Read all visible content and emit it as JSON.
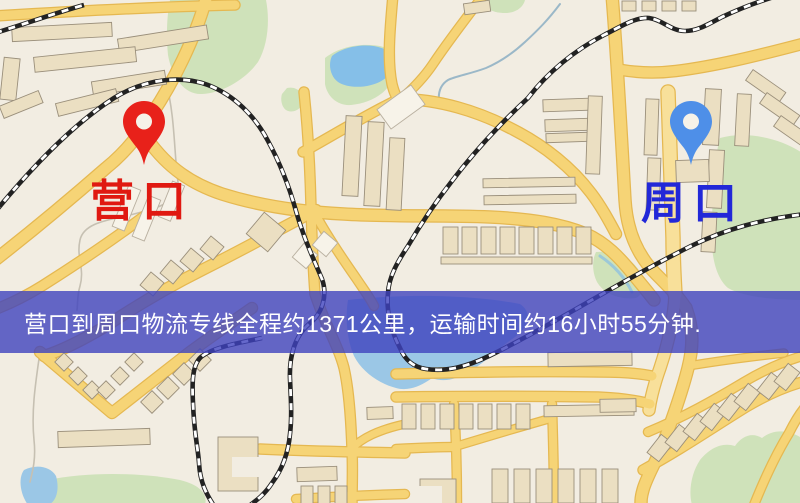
{
  "origin": {
    "label": "营口"
  },
  "destination": {
    "label": "周口"
  },
  "banner": {
    "text": "营口到周口物流专线全程约1371公里，运输时间约16小时55分钟."
  },
  "colors": {
    "background": "#F2EDE2",
    "road_fill": "#F6D476",
    "road_casing": "#E5B851",
    "road_pale": "#F8E09A",
    "building_fill": "#EBDFC2",
    "building_stroke": "#9A8F7B",
    "building_pale": "#F7F3E9",
    "green": "#CFE2BA",
    "water": "#9BC7E6",
    "water_bright": "#85BFE8",
    "rail_dark": "#222222",
    "rail_light": "#FFFFFF",
    "stream": "#A8C4CF",
    "origin_pin": "#E8211A",
    "origin_label": "#E01911",
    "destination_pin": "#4E8FE8",
    "destination_label": "#2228D8",
    "banner_bg": "rgba(62,66,190,0.80)",
    "banner_text": "#FFFFFF"
  }
}
